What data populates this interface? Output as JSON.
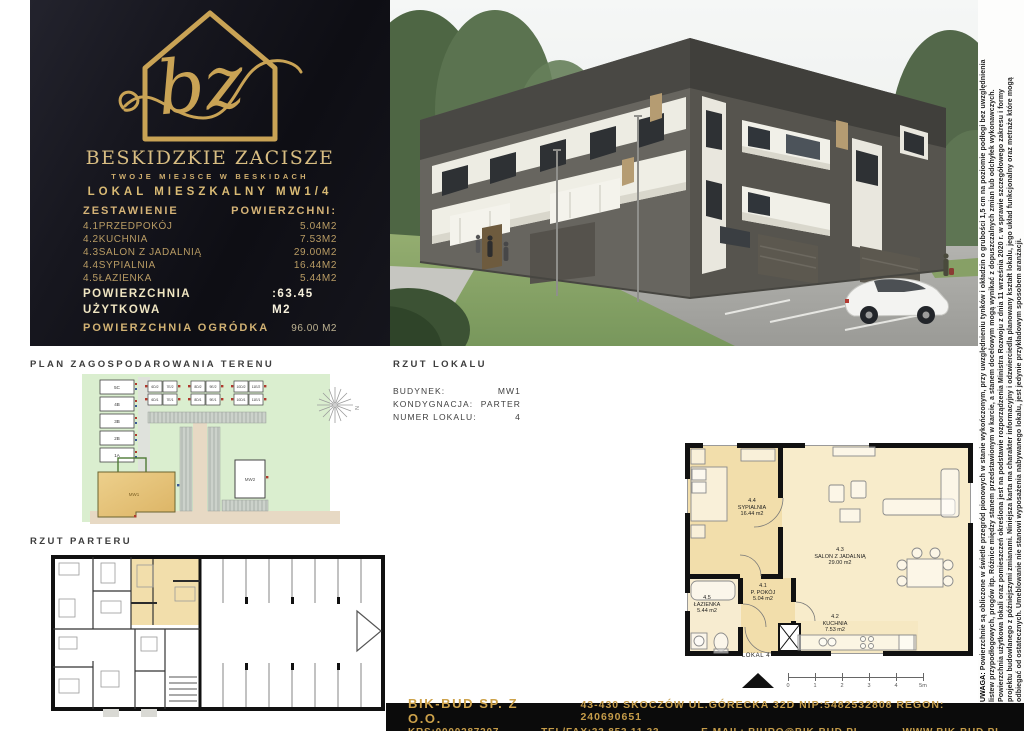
{
  "colors": {
    "gold": "#c9a355",
    "panel_black": "#14141b",
    "cream": "#efe5c2",
    "plan_tan": "#f2deab",
    "site_green": "#daeecf",
    "footer_gold": "#c59c49"
  },
  "brand": {
    "monogram": "bz",
    "name": "BESKIDZKIE ZACISZE",
    "tagline": "TWOJE MIEJSCE W BESKIDACH",
    "unit_title": "LOKAL MIESZKALNY MW1/4",
    "table": {
      "header_left": "ZESTAWIENIE",
      "header_right": "POWIERZCHNI:",
      "rows": [
        {
          "label": "4.1PRZEDPOKÓJ",
          "value": "5.04M2"
        },
        {
          "label": "4.2KUCHNIA",
          "value": "7.53M2"
        },
        {
          "label": "4.3SALON Z JADALNIĄ",
          "value": "29.00M2"
        },
        {
          "label": "4.4SYPIALNIA",
          "value": "16.44M2"
        },
        {
          "label": "4.5ŁAZIENKA",
          "value": "5.44M2"
        }
      ],
      "total_label": "POWIERZCHNIA UŻYTKOWA",
      "total_value": ":63.45 M2"
    },
    "garden_label": "POWIERZCHNIA OGRÓDKA",
    "garden_value": "96.00 M2"
  },
  "site_plan": {
    "title": "PLAN ZAGOSPODAROWANIA TERENU",
    "houses_left": [
      "5C",
      "4B",
      "3B",
      "2B",
      "1A"
    ],
    "duplexes": [
      [
        "6D/2",
        "7E/2",
        "6D/1",
        "7E/1"
      ],
      [
        "8D/2",
        "9E/2",
        "8D/1",
        "9E/1"
      ],
      [
        "10D/2",
        "11E/2",
        "10D/1",
        "11E/1"
      ]
    ],
    "building_highlight": "MW1",
    "building_other": "MW2",
    "compass_label": "N"
  },
  "unit_sheet": {
    "title": "RZUT LOKALU",
    "fields": [
      {
        "label": "BUDYNEK:",
        "value": "MW1"
      },
      {
        "label": "KONDYGNACJA:",
        "value": "PARTER"
      },
      {
        "label": "NUMER LOKALU:",
        "value": "4"
      }
    ],
    "rooms": [
      {
        "no": "4.4",
        "name": "SYPIALNIA",
        "area": "16.44 m2"
      },
      {
        "no": "4.3",
        "name": "SALON Z JADALNIĄ",
        "area": "29.00 m2"
      },
      {
        "no": "4.1",
        "name": "P. POKÓJ",
        "area": "5.04 m2"
      },
      {
        "no": "4.5",
        "name": "ŁAZIENKA",
        "area": "5.44 m2"
      },
      {
        "no": "4.2",
        "name": "KUCHNIA",
        "area": "7.53 m2"
      }
    ],
    "unit_label": "LOKAL 4",
    "scale_ticks": [
      "0",
      "1",
      "2",
      "3",
      "4",
      "5m"
    ]
  },
  "floor_plan": {
    "title": "RZUT PARTERU"
  },
  "disclaimer": {
    "heading": "UWAGA:",
    "lines": [
      "Powierzchnie są obliczone w świetle przegród pionowych w stanie wykończonym, przy uwzględnieniu tynków i okładzin o grubości 1,5 cm na poziomie podłogi bez uwzględnienia",
      "listew przypodłogowych, progów itp. Różnice między stanem przedstawionym w karcie, a stanem docelowym mogą wynikać z dopuszczalnych zmian lub odchyłek wykonawczych.",
      "Powierzchnia użytkowa lokali oraz pomieszczeń określona jest na podstawie rozporządzenia Ministra Rozwoju z dnia 11 września 2020 r. w sprawie szczegółowego zakresu i formy",
      "projektu budowlanego z późniejszymi zmianami. Niniejsza karta ma charakter informacyjny i odzwierciedla planowany kształt lokalu, jego układ funkcjonalny oraz metraże które mogą",
      "odbiegać od ostatecznych. Umeblowanie nie stanowi wyposażenia nabywanego lokalu, jest jedynie przykładowym sposobem aranżacji."
    ]
  },
  "footer": {
    "company": "BIK-BUD SP. Z O.O.",
    "address": "43-430 SKOCZÓW UL.GÓRECKA 32D NIP:5482532808 REGON: 240690651",
    "krs": "KRS:0000287207",
    "tel": "TEL/FAX:33 853 11 33",
    "email": "E-MAIL: BIURO@BIK-BUD.PL",
    "www": "WWW.BIK-BUD.PL"
  }
}
